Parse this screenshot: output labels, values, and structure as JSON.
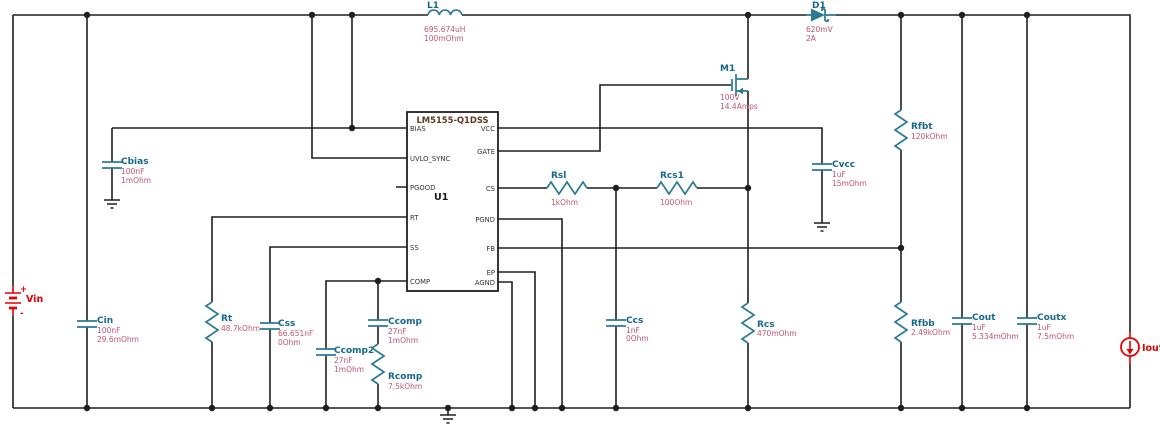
{
  "ic": {
    "part": "LM5155-Q1DSS",
    "refdes": "U1",
    "left_pins": [
      "BIAS",
      "UVLO_SYNC",
      "PGOOD",
      "RT",
      "SS",
      "COMP"
    ],
    "right_pins": [
      "VCC",
      "GATE",
      "CS",
      "PGND",
      "FB",
      "EP",
      "AGND"
    ]
  },
  "components": {
    "L1": {
      "name": "L1",
      "values": [
        "695.674uH",
        "100mOhm"
      ]
    },
    "D1": {
      "name": "D1",
      "values": [
        "620mV",
        "2A"
      ]
    },
    "M1": {
      "name": "M1",
      "values": [
        "100V",
        "14.4Amps"
      ]
    },
    "Vin": {
      "name": "Vin",
      "plus": "+",
      "minus": "-"
    },
    "Iout": {
      "name": "Iout"
    },
    "Cbias": {
      "name": "Cbias",
      "values": [
        "100nF",
        "1mOhm"
      ]
    },
    "Cin": {
      "name": "Cin",
      "values": [
        "100nF",
        "29.6mOhm"
      ]
    },
    "Rt": {
      "name": "Rt",
      "values": [
        "48.7kOhm"
      ]
    },
    "Css": {
      "name": "Css",
      "values": [
        "66.651nF",
        "0Ohm"
      ]
    },
    "Ccomp2": {
      "name": "Ccomp2",
      "values": [
        "27nF",
        "1mOhm"
      ]
    },
    "Ccomp": {
      "name": "Ccomp",
      "values": [
        "27nF",
        "1mOhm"
      ]
    },
    "Rcomp": {
      "name": "Rcomp",
      "values": [
        "7.5kOhm"
      ]
    },
    "Rsl": {
      "name": "Rsl",
      "values": [
        "1kOhm"
      ]
    },
    "Rcs1": {
      "name": "Rcs1",
      "values": [
        "100Ohm"
      ]
    },
    "Ccs": {
      "name": "Ccs",
      "values": [
        "1nF",
        "0Ohm"
      ]
    },
    "Rcs": {
      "name": "Rcs",
      "values": [
        "470mOhm"
      ]
    },
    "Cvcc": {
      "name": "Cvcc",
      "values": [
        "1uF",
        "15mOhm"
      ]
    },
    "Rfbt": {
      "name": "Rfbt",
      "values": [
        "120kOhm"
      ]
    },
    "Rfbb": {
      "name": "Rfbb",
      "values": [
        "2.49kOhm"
      ]
    },
    "Cout": {
      "name": "Cout",
      "values": [
        "1uF",
        "5.334mOhm"
      ]
    },
    "Coutx": {
      "name": "Coutx",
      "values": [
        "1uF",
        "7.5mOhm"
      ]
    }
  },
  "colors": {
    "wire": "#1f1f1f",
    "symbol": "#2b7a94",
    "component_label": "#16688e",
    "component_value": "#c1566e",
    "source_red": "#e60000",
    "ic_title": "#5c3a21",
    "background": "#ffffff"
  }
}
